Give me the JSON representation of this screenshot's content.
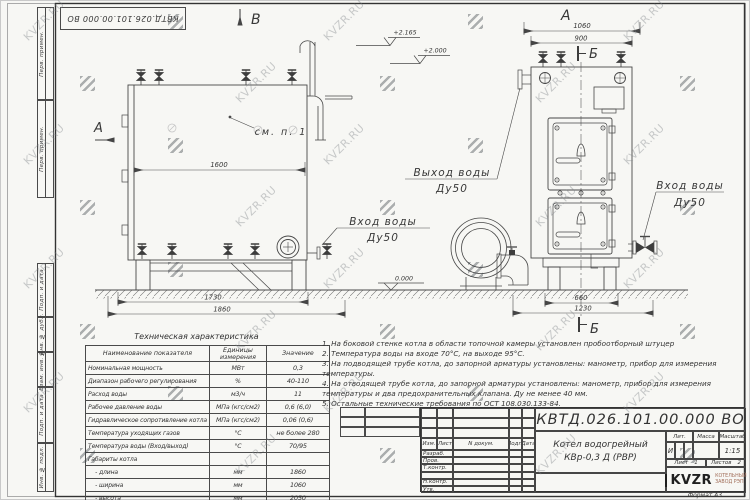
{
  "watermark": {
    "text": "KVZR.RU"
  },
  "sheet": {
    "stamp": "КВТД.026.101.00.000 ВО",
    "format_label": "Формат А3",
    "margin_labels": [
      "Перв. примен.",
      "Перв. примен.",
      "Подп. и дата",
      "Инв. № дубл.",
      "Взам. инв. №",
      "Подп. и дата",
      "Инв. № подл."
    ]
  },
  "drawing": {
    "markers": {
      "v": "В",
      "a_side": "А",
      "a_front": "А",
      "b_top": "Б",
      "b_bottom": "Б"
    },
    "labels": {
      "see_note": "см. п. 1",
      "inlet_side_1": "Вход воды",
      "inlet_side_2": "Ду50",
      "outlet_1": "Выход воды",
      "outlet_2": "Ду50",
      "inlet_front_1": "Вход воды",
      "inlet_front_2": "Ду50"
    },
    "elevations": {
      "e1": "+2.165",
      "e2": "+2.000",
      "zero": "0.000"
    },
    "dims": {
      "d1600": "1600",
      "d1730": "1730",
      "d1860": "1860",
      "d1060": "1060",
      "d900": "900",
      "d660": "660",
      "d1230": "1230"
    }
  },
  "tech_table": {
    "title": "Техническая характеристика",
    "headers": [
      "Наименование показателя",
      "Единицы измерения",
      "Значение"
    ],
    "rows": [
      [
        "Номинальная мощность",
        "МВт",
        "0,3"
      ],
      [
        "Диапазон рабочего регулирования",
        "%",
        "40-110"
      ],
      [
        "Расход воды",
        "м3/ч",
        "11"
      ],
      [
        "Рабочее давление воды",
        "МПа (кгс/см2)",
        "0,6 (6,0)"
      ],
      [
        "Гидравлическое сопротивление котла",
        "МПа (кгс/см2)",
        "0,06 (0,6)"
      ],
      [
        "Температура уходящих газов",
        "°С",
        "не более 280"
      ],
      [
        "Температура воды (Вход/выход)",
        "°С",
        "70/95"
      ],
      [
        "Габариты котла",
        "",
        ""
      ],
      [
        "    - длина",
        "мм",
        "1860"
      ],
      [
        "    - ширина",
        "мм",
        "1060"
      ],
      [
        "    - высота",
        "мм",
        "2050"
      ]
    ]
  },
  "notes": [
    "1.  На боковой стенке котла в области топочной камеры установлен пробоотборный штуцер",
    "2.  Температура воды на входе  70°С,  на выходе  95°С.",
    "3.  На подводящей трубе котла, до запорной арматуры установлены:  манометр, прибор для измерения температуры.",
    "4.  На отводящей трубе котла, до запорной арматуры установлены:  манометр, прибор для измерения температуры и два предохранительных клапана.  Ду не менее  40 мм.",
    "5.  Остальные технические требования по ОСТ  108.030.133-84."
  ],
  "title_block": {
    "doc_number": "КВТД.026.101.00.000  ВО",
    "name_line1": "Котел водогрейный",
    "name_line2": "КВр-0,3 Д (РВР)",
    "header_cols": [
      "Изм.",
      "Лист",
      "N докум.",
      "Подп.",
      "Дата"
    ],
    "row_labels": [
      "Разраб.",
      "Пров.",
      "Т.контр.",
      "",
      "Н.контр.",
      "Утв."
    ],
    "lit_label": "Лит.",
    "mass_label": "Масса",
    "scale_label": "Масштаб",
    "lit_value": "И",
    "scale_value": "1:15",
    "sheet_label": "Лист",
    "sheet_value": "1",
    "sheets_label": "Листов",
    "sheets_value": "2",
    "logo_text": "KVZR",
    "logo_sub1": "КОТЕЛЬНЫЙ",
    "logo_sub2": "ЗАВОД РЭП",
    "logo_accent": "#a3705c"
  }
}
